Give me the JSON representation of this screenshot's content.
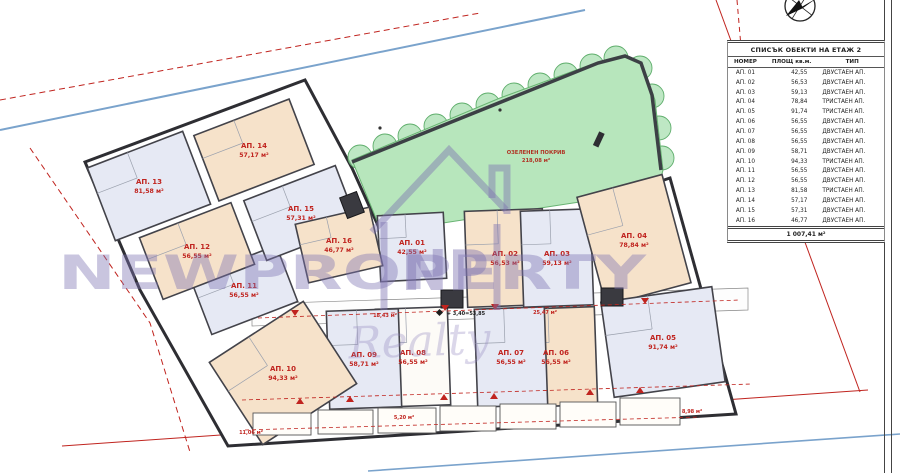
{
  "plan": {
    "green_roof": {
      "label": "ОЗЕЛЕНЕН ПОКРИВ",
      "area": "218,08 м²"
    },
    "level_mark": "+ 3,40=53,85",
    "balcony_labels": [
      "18,43 м²",
      "25,47 м²",
      "11,06 м²",
      "5,20 м²",
      "8,98 м²"
    ],
    "apartments": [
      {
        "id": "АП. 01",
        "area": "42,55 м²"
      },
      {
        "id": "АП. 02",
        "area": "56,53 м²"
      },
      {
        "id": "АП. 03",
        "area": "59,13 м²"
      },
      {
        "id": "АП. 04",
        "area": "78,84 м²"
      },
      {
        "id": "АП. 05",
        "area": "91,74 м²"
      },
      {
        "id": "АП. 06",
        "area": "56,55 м²"
      },
      {
        "id": "АП. 07",
        "area": "56,55 м²"
      },
      {
        "id": "АП. 08",
        "area": "56,55 м²"
      },
      {
        "id": "АП. 09",
        "area": "58,71 м²"
      },
      {
        "id": "АП. 10",
        "area": "94,33 м²"
      },
      {
        "id": "АП. 11",
        "area": "56,55 м²"
      },
      {
        "id": "АП. 12",
        "area": "56,55 м²"
      },
      {
        "id": "АП. 13",
        "area": "81,58 м²"
      },
      {
        "id": "АП. 14",
        "area": "57,17 м²"
      },
      {
        "id": "АП. 15",
        "area": "57,31 м²"
      },
      {
        "id": "АП. 16",
        "area": "46,77 м²"
      }
    ]
  },
  "watermark": {
    "brand": "NEWPROPERTY",
    "logo_letters": "NP",
    "script_word": "Realty"
  },
  "table": {
    "title": "СПИСЪК ОБЕКТИ НА ЕТАЖ 2",
    "columns": [
      "НОМЕР",
      "ПЛОЩ кв.м.",
      "ТИП"
    ],
    "rows": [
      [
        "АП. 01",
        "42,55",
        "ДВУСТАЕН АП."
      ],
      [
        "АП. 02",
        "56,53",
        "ДВУСТАЕН АП."
      ],
      [
        "АП. 03",
        "59,13",
        "ДВУСТАЕН АП."
      ],
      [
        "АП. 04",
        "78,84",
        "ТРИСТАЕН АП."
      ],
      [
        "АП. 05",
        "91,74",
        "ТРИСТАЕН АП."
      ],
      [
        "АП. 06",
        "56,55",
        "ДВУСТАЕН АП."
      ],
      [
        "АП. 07",
        "56,55",
        "ДВУСТАЕН АП."
      ],
      [
        "АП. 08",
        "56,55",
        "ДВУСТАЕН АП."
      ],
      [
        "АП. 09",
        "58,71",
        "ДВУСТАЕН АП."
      ],
      [
        "АП. 10",
        "94,33",
        "ТРИСТАЕН АП."
      ],
      [
        "АП. 11",
        "56,55",
        "ДВУСТАЕН АП."
      ],
      [
        "АП. 12",
        "56,55",
        "ДВУСТАЕН АП."
      ],
      [
        "АП. 13",
        "81,58",
        "ТРИСТАЕН АП."
      ],
      [
        "АП. 14",
        "57,17",
        "ДВУСТАЕН АП."
      ],
      [
        "АП. 15",
        "57,31",
        "ДВУСТАЕН АП."
      ],
      [
        "АП. 16",
        "46,77",
        "ДВУСТАЕН АП."
      ]
    ],
    "total": "1 007,41 м²"
  },
  "colors": {
    "annotation_red": "#c0241f",
    "green_roof": "#b7e6bc",
    "unit_beige": "#f6e2ca",
    "unit_blue": "#e6e9f4",
    "watermark_purple": "#7f74b2",
    "street_blue": "#7aa3cc"
  }
}
